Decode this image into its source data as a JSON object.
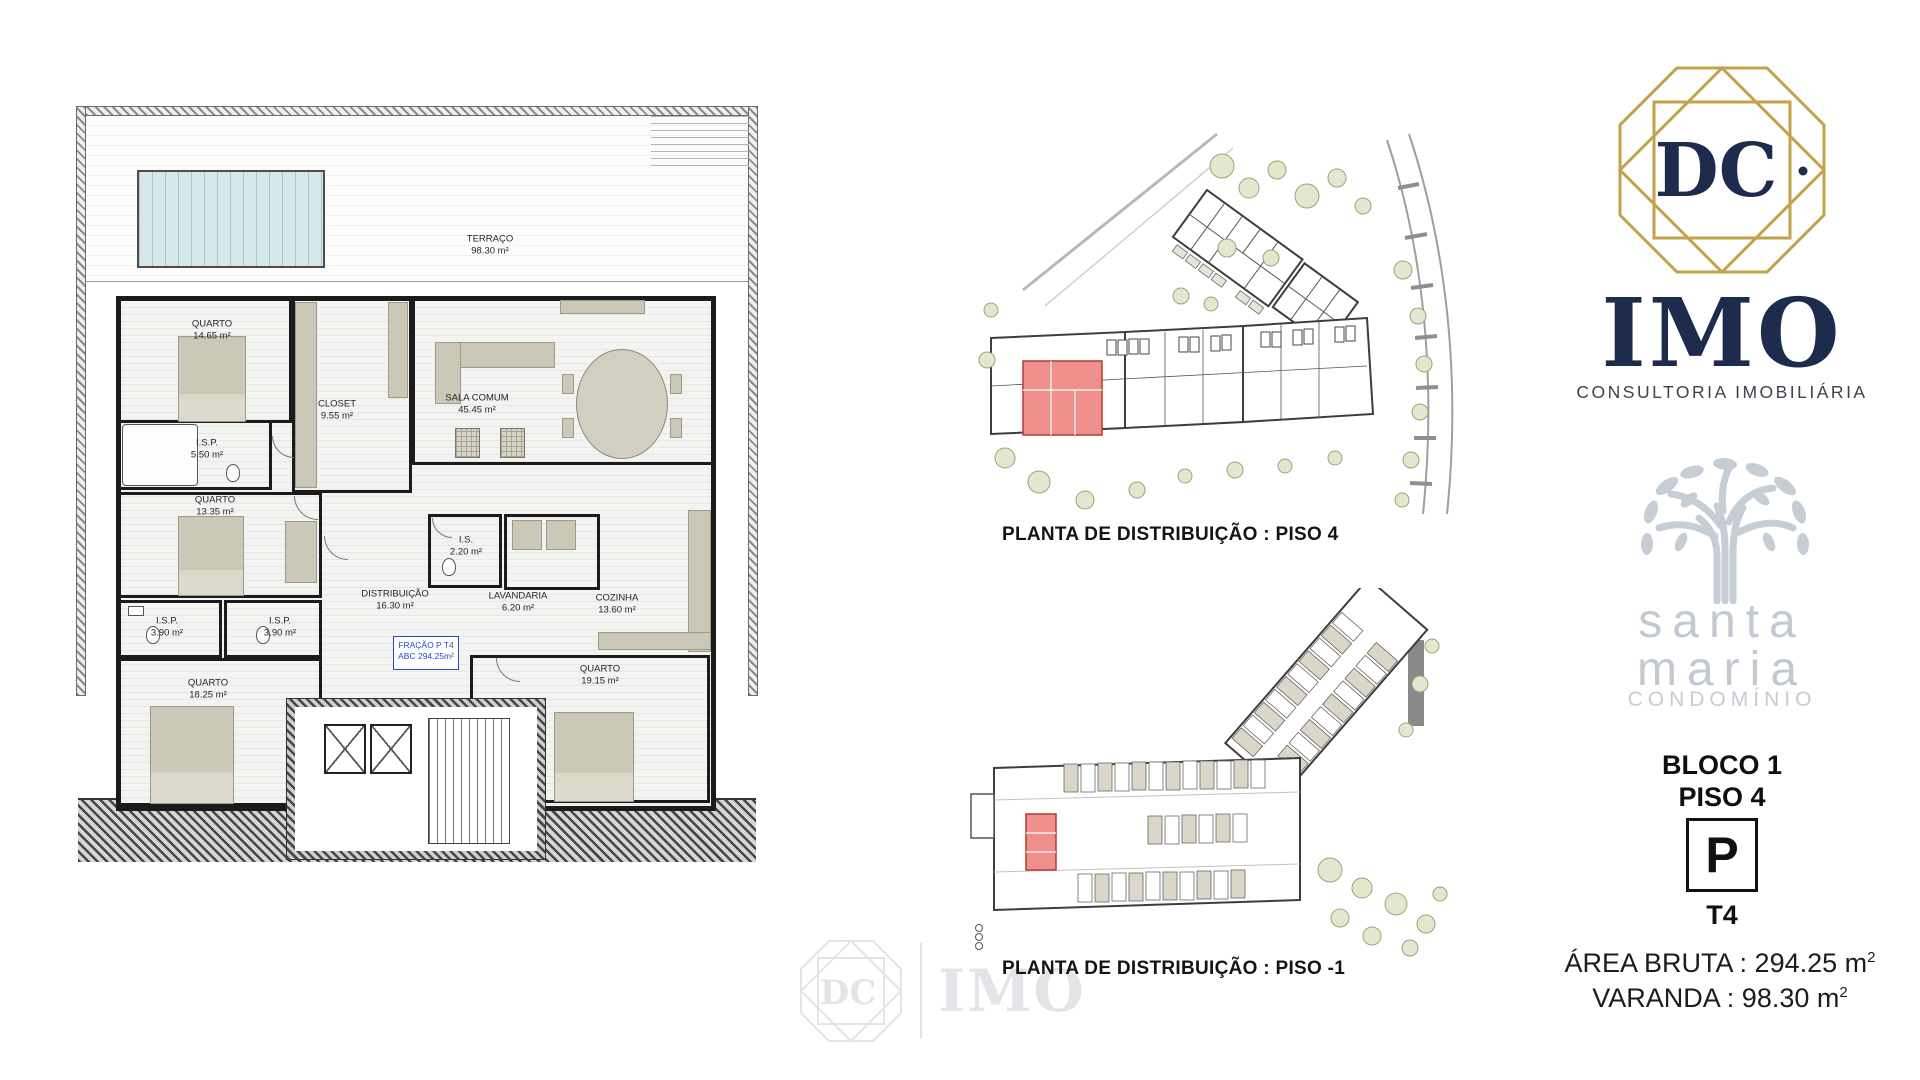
{
  "floor_plan": {
    "terrace": {
      "name": "TERRAÇO",
      "area": "98.30 m²"
    },
    "rooms": [
      {
        "name": "QUARTO",
        "area": "14.65 m²"
      },
      {
        "name": "CLOSET",
        "area": "9.55 m²"
      },
      {
        "name": "SALA COMUM",
        "area": "45.45 m²"
      },
      {
        "name": "I.S.P.",
        "area": "5.50 m²"
      },
      {
        "name": "QUARTO",
        "area": "13.35 m²"
      },
      {
        "name": "I.S.",
        "area": "2.20 m²"
      },
      {
        "name": "DISTRIBUIÇÃO",
        "area": "16.30 m²"
      },
      {
        "name": "LAVANDARIA",
        "area": "6.20 m²"
      },
      {
        "name": "COZINHA",
        "area": "13.60 m²"
      },
      {
        "name": "I.S.P.",
        "area": "3.90 m²"
      },
      {
        "name": "I.S.P.",
        "area": "3.90 m²"
      },
      {
        "name": "QUARTO",
        "area": "18.25 m²"
      },
      {
        "name": "QUARTO",
        "area": "19.15 m²"
      }
    ],
    "fraction_tag": {
      "line1": "FRAÇÃO P T4",
      "line2": "ABC 294.25m²"
    }
  },
  "site_plans": {
    "piso4_caption": "PLANTA DE DISTRIBUIÇÃO : PISO 4",
    "piso_minus1_caption": "PLANTA DE DISTRIBUIÇÃO : PISO -1"
  },
  "branding": {
    "monogram": "DC",
    "brand": "IMO",
    "brand_subtitle": "CONSULTORIA IMOBILIÁRIA",
    "condo_line1": "santa",
    "condo_line2": "maria",
    "condo_subtitle": "CONDOMÍNIO",
    "watermark_monogram": "DC",
    "watermark_brand": "IMO"
  },
  "unit_info": {
    "block": "BLOCO 1",
    "floor": "PISO 4",
    "parking": "P",
    "typology": "T4",
    "gross_area_text": "ÁREA BRUTA : 294.25 m",
    "gross_area_sup": "2",
    "balcony_text": "VARANDA : 98.30 m",
    "balcony_sup": "2"
  },
  "colors": {
    "navy": "#1d2c4c",
    "gold": "#c3a24c",
    "logo_gray": "#c6cdd4",
    "highlight_red": "#ee8f8b"
  }
}
